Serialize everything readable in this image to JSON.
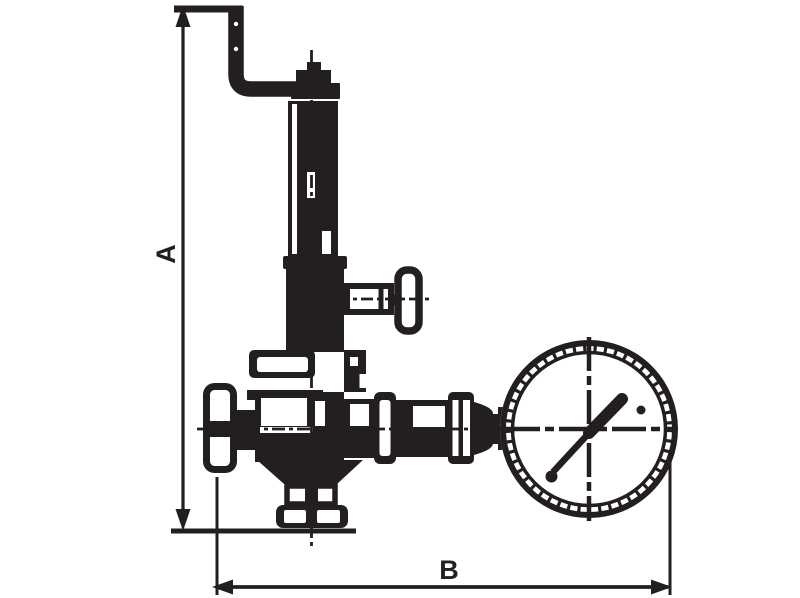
{
  "meta": {
    "drawing_type": "technical dimensional line drawing",
    "subject": "safety relief valve with discharge pipe, side adjustment handle and pressure gauge",
    "background_color": "#ffffff",
    "ink_color": "#231f20"
  },
  "dimensions": {
    "height_label": "A",
    "width_label": "B"
  },
  "gauge": {
    "needle_angle_deg": 46,
    "has_tick_ring": true,
    "has_crosshair": true
  },
  "components": [
    "discharge-pipe",
    "spring-housing",
    "adjustment-handle",
    "bonnet-flange",
    "valve-body",
    "inlet-connector",
    "gauge-union-fitting",
    "pressure-gauge",
    "drain-fitting",
    "dimension-a",
    "dimension-b"
  ]
}
